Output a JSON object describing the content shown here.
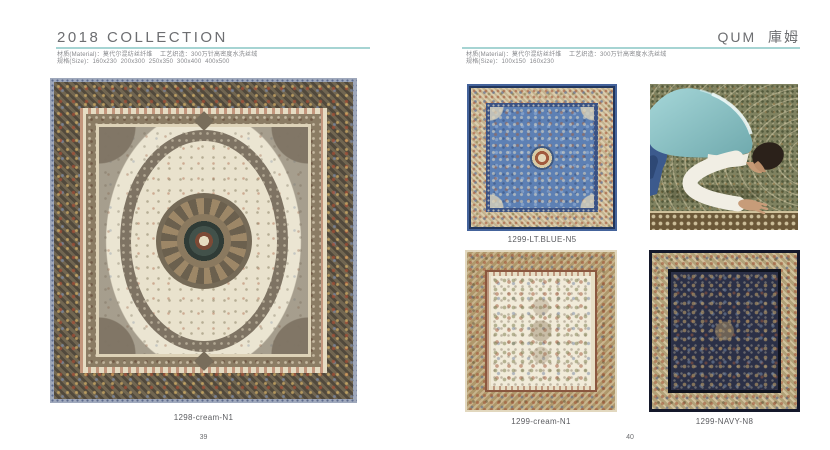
{
  "left": {
    "title": "2018 COLLECTION",
    "material": "材质(Material)：莫代尔混纺丝纤维    工艺织造：300万针高密度水洗丝绒",
    "sizes": "规格(Size)：160x230  200x300  250x350  300x400  400x500",
    "product_code": "1298-cream-N1",
    "page_number": "39"
  },
  "right": {
    "title_en": "QUM",
    "title_zh": "庫姆",
    "material": "材质(Material)：莫代尔混纺丝纤维    工艺织造：300万针高密度水洗丝绒",
    "sizes": "规格(Size)：100x150  160x230",
    "products": [
      {
        "code": "1299-LT.BLUE-N5"
      },
      {
        "code": "1299-cream-N1"
      },
      {
        "code": "1299-NAVY-N8"
      }
    ],
    "page_number": "40"
  },
  "colors": {
    "accent_rule": "#a6d4d3",
    "heading_text": "#6d6e71",
    "meta_text": "#87888c",
    "caption_text": "#5b5c60",
    "blue_rug_field": "#5d80b4",
    "navy_rug_field": "#2b3047",
    "cream_rug_field": "#f1ebd9"
  }
}
